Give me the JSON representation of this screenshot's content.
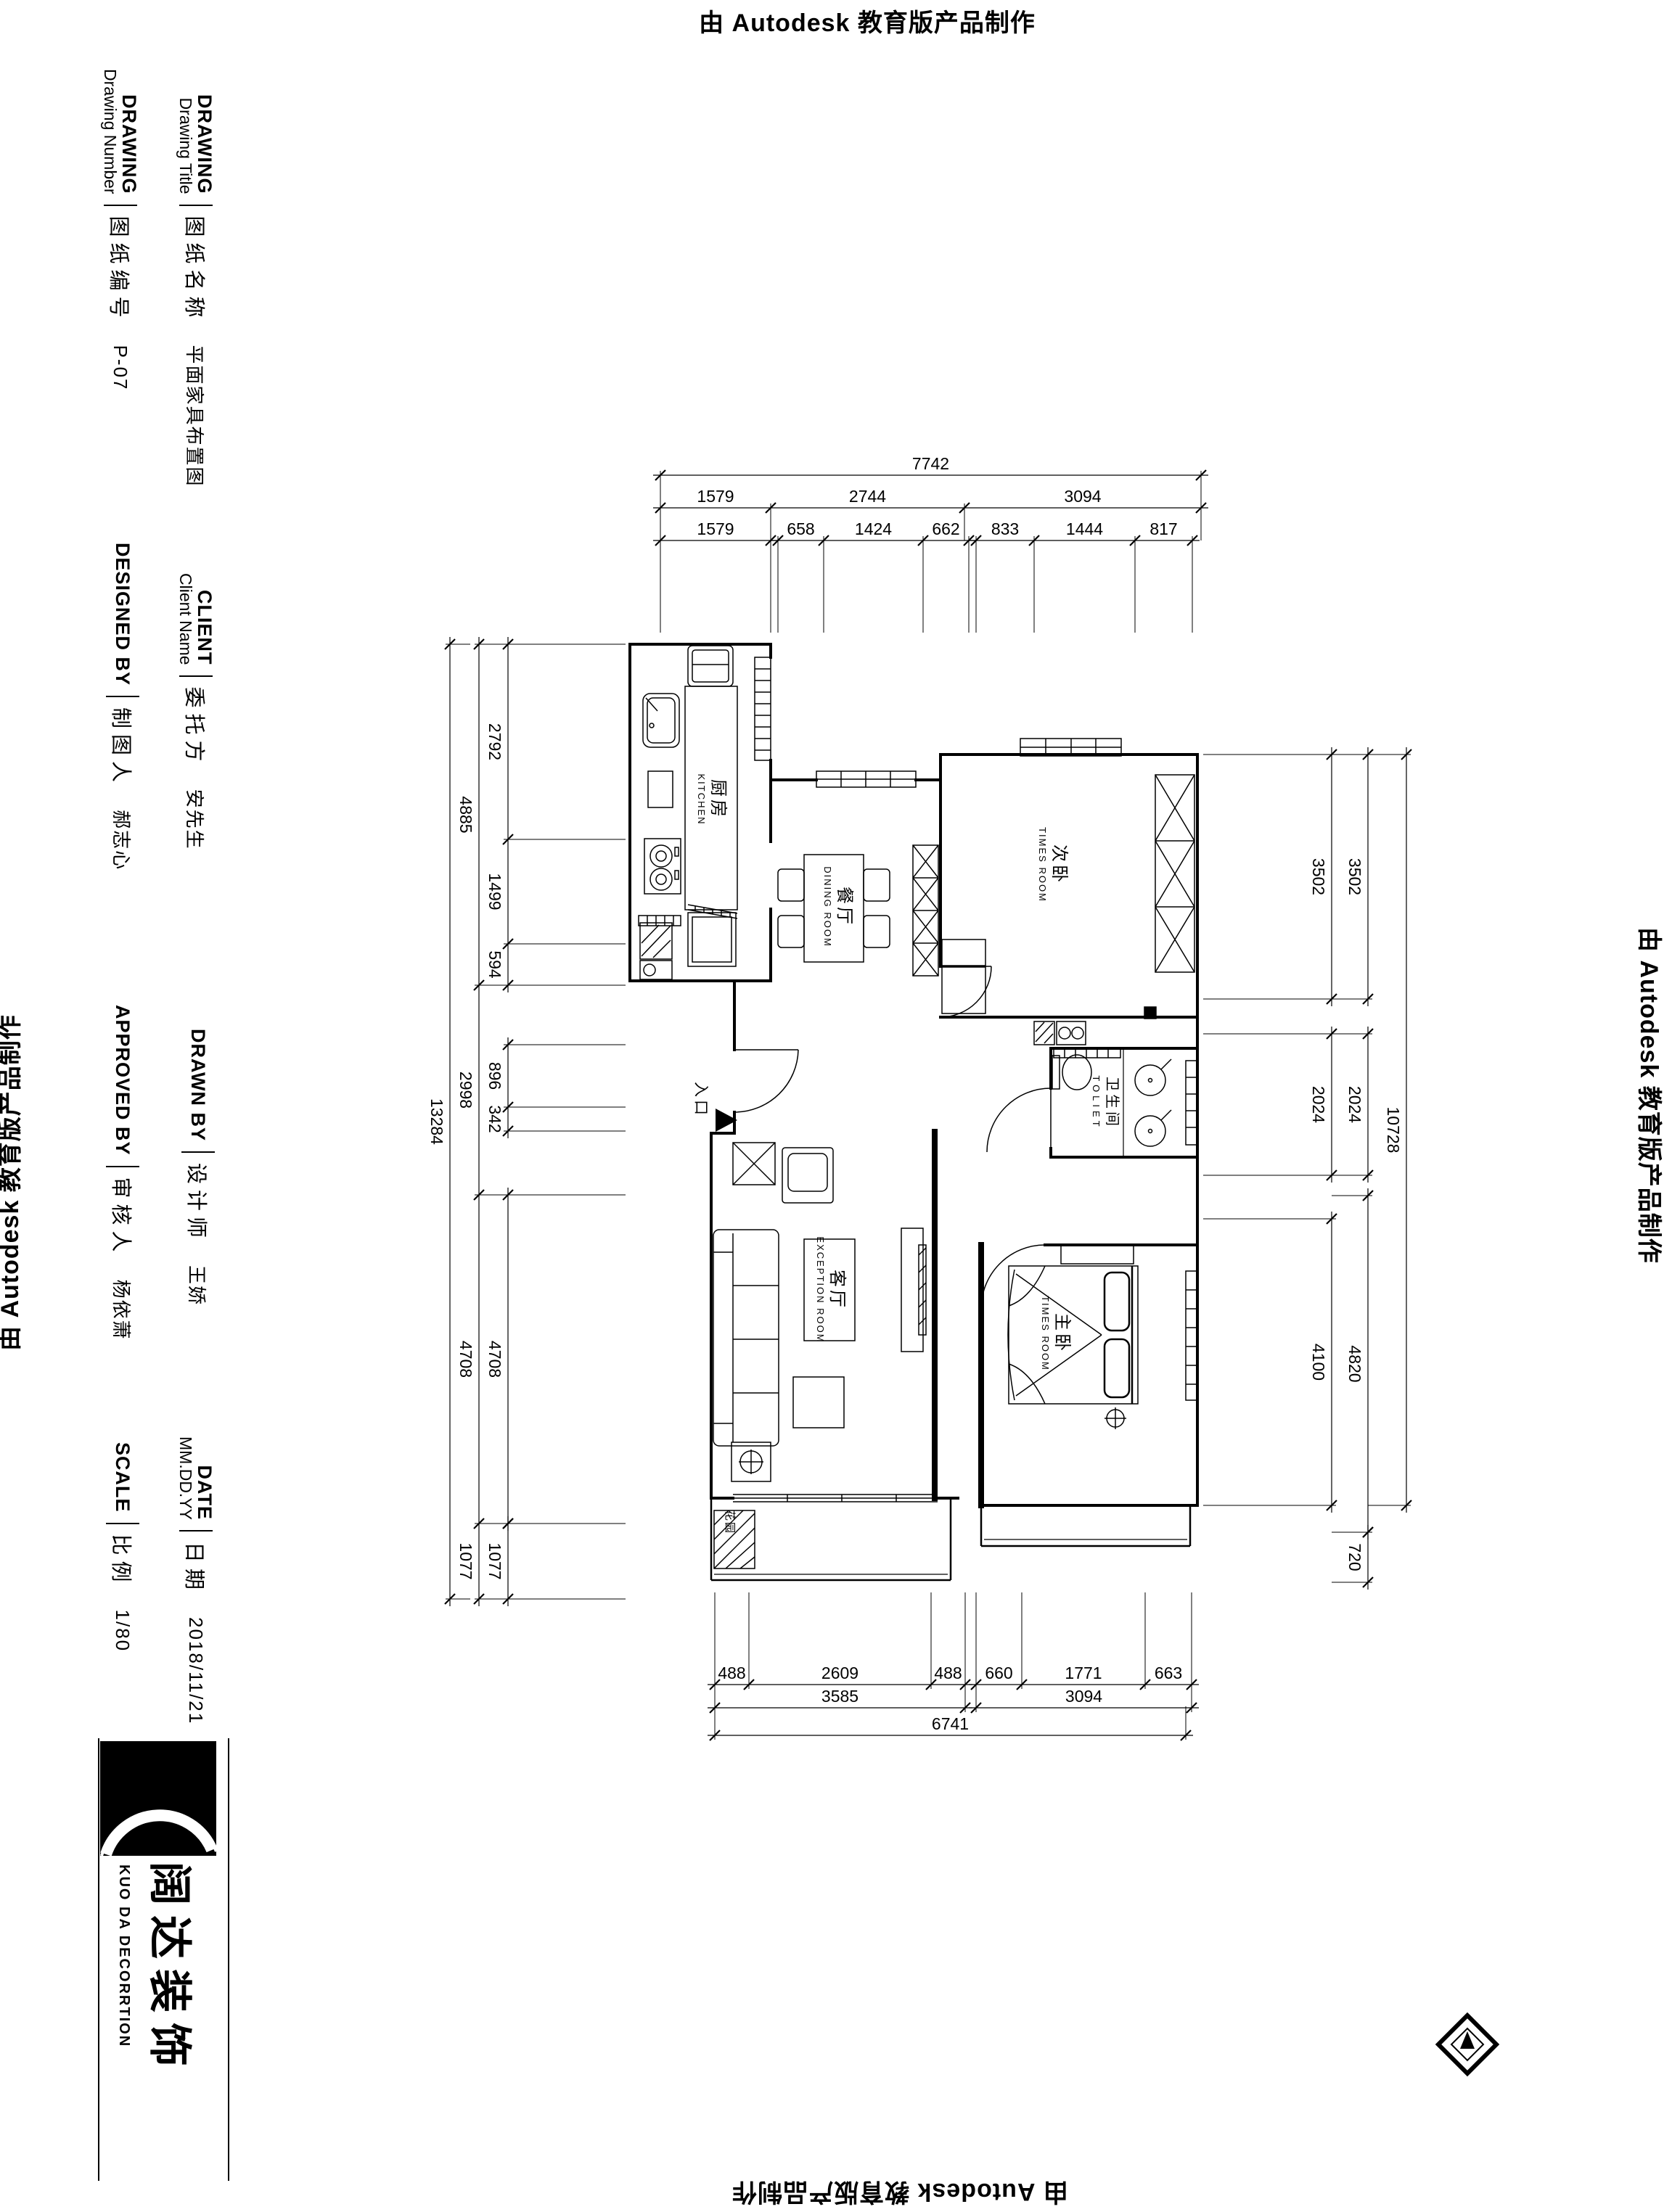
{
  "stamps": {
    "autodesk": "由 Autodesk 教育版产品制作"
  },
  "title_block": {
    "entries": [
      {
        "en_bold": "DRAWING",
        "en_sub": "Drawing Number",
        "zh": "图纸编号",
        "value": "P-07"
      },
      {
        "en_bold": "DRAWING",
        "en_sub": "Drawing Title",
        "zh": "图纸名称",
        "value": "平面家具布置图"
      },
      {
        "en_bold": "DESIGNED BY",
        "en_sub": "",
        "zh": "制图人",
        "value": "郝志心"
      },
      {
        "en_bold": "CLIENT",
        "en_sub": "Client Name",
        "zh": "委托方",
        "value": "安先生"
      },
      {
        "en_bold": "APPROVED BY",
        "en_sub": "",
        "zh": "审核人",
        "value": "杨依萧"
      },
      {
        "en_bold": "DRAWN BY",
        "en_sub": "",
        "zh": "设计师",
        "value": "王娇"
      },
      {
        "en_bold": "SCALE",
        "en_sub": "",
        "zh": "比例",
        "value": "1/80"
      },
      {
        "en_bold": "DATE",
        "en_sub": "MM.DD.YY",
        "zh": "日期",
        "value": "2018/11/21"
      }
    ]
  },
  "logo": {
    "zh": "阔达装饰",
    "en": "KUO DA DECORRTION"
  },
  "plan": {
    "rooms": [
      {
        "zh": "厨房",
        "en": "KITCHEN"
      },
      {
        "zh": "餐厅",
        "en": "DINING ROOM"
      },
      {
        "zh": "次卧",
        "en": "TIMES ROOM"
      },
      {
        "zh": "卫生间",
        "en": "TOLIET"
      },
      {
        "zh": "客厅",
        "en": "EXCEPTION ROOM"
      },
      {
        "zh": "主卧",
        "en": "TIMES ROOM"
      }
    ],
    "labels": {
      "entrance": "入口",
      "garden": "花园"
    },
    "dims": {
      "top_total": "7742",
      "top_mid": [
        "1579",
        "2744",
        "3094"
      ],
      "top_inner": [
        "1579",
        "658",
        "1424",
        "662",
        "833",
        "1444",
        "817"
      ],
      "left_total": "13284",
      "left_mid": [
        "4885",
        "2998",
        "4708",
        "1077"
      ],
      "left_inner": [
        "2792",
        "1499",
        "594",
        "896",
        "342",
        "4708",
        "1077"
      ],
      "right_outer": "10728",
      "right_mid": [
        "3502",
        "2024",
        "4820",
        "720"
      ],
      "right_inner": [
        "3502",
        "2024",
        "4100"
      ],
      "bottom_inner": [
        "488",
        "2609",
        "488",
        "660",
        "1771",
        "663"
      ],
      "bottom_mid": [
        "3585",
        "3094"
      ],
      "bottom_total": "6741"
    }
  }
}
